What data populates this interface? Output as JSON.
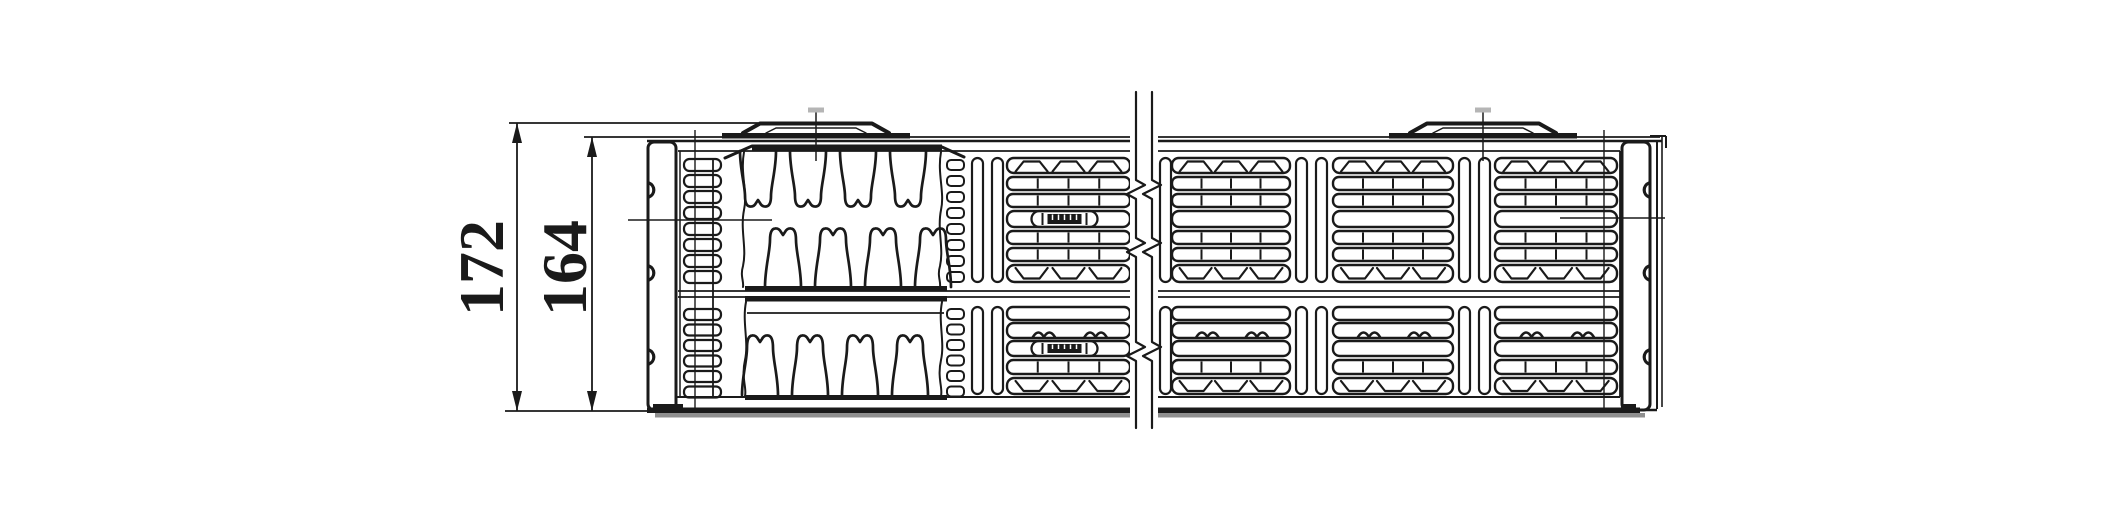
{
  "drawing": {
    "dimensions": [
      {
        "id": "overall-depth",
        "label": "172"
      },
      {
        "id": "panel-depth",
        "label": "164"
      }
    ]
  },
  "colors": {
    "ink": "#1a1a1a",
    "background": "#ffffff",
    "shadow": "#8f8f8f",
    "bracket_tick": "#b5b5b5"
  }
}
